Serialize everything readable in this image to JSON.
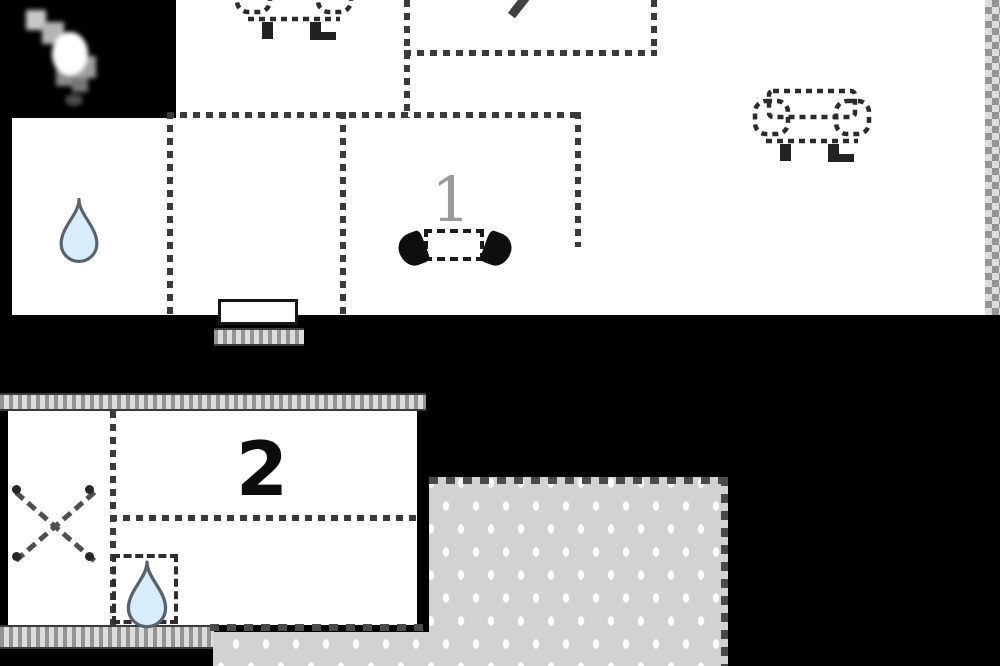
{
  "title": "holiday-home floor plan",
  "labels": {
    "living_room_number": "1",
    "bedroom_number": "2"
  },
  "icons": {
    "sofa_top": "sofa-icon",
    "sofa_right": "sofa-icon",
    "stove": "wood-stove-icon",
    "bathroom_drop": "water-drop-icon",
    "annex_drop": "water-drop-icon",
    "window_cross": "cross-mark-icon",
    "pointer": "cursor-icon"
  },
  "colors": {
    "background": "#000000",
    "floor": "#ffffff",
    "dash": "#3a3a3a",
    "terrace": "#d2d2d2",
    "terrace_dot": "#ffffff",
    "drop_fill": "#d7edf9",
    "drop_outline": "#57626e",
    "hatch_dark": "#949494",
    "hatch_light": "#dcdcdc"
  }
}
